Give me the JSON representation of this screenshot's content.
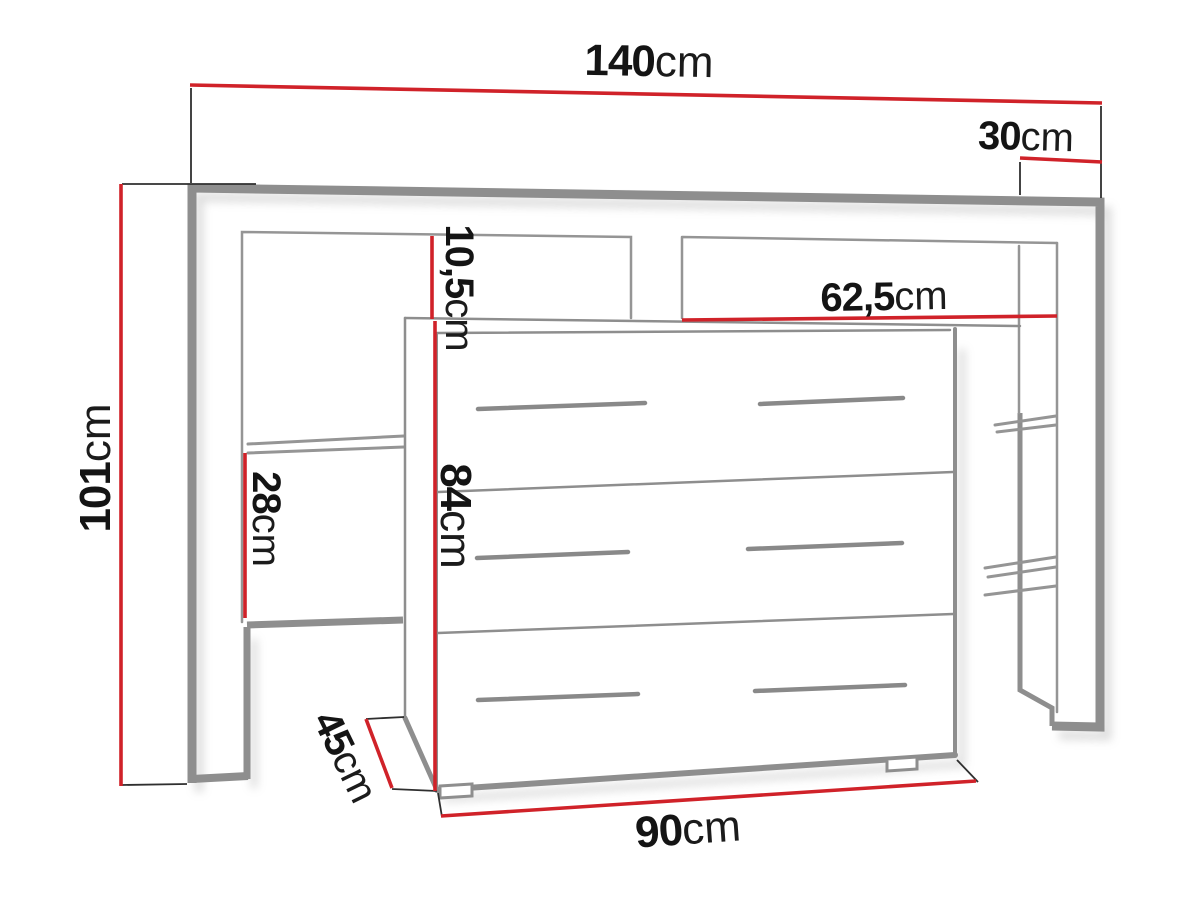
{
  "colors": {
    "dimension_line": "#d02229",
    "extension_line": "#2f2f2f",
    "furniture_outline": "#8e8e8e",
    "label_text": "#141414",
    "background": "#ffffff"
  },
  "dimensions": [
    {
      "id": "total_width",
      "value": "140",
      "unit": "cm"
    },
    {
      "id": "side_depth",
      "value": "30",
      "unit": "cm"
    },
    {
      "id": "total_height",
      "value": "101",
      "unit": "cm"
    },
    {
      "id": "niche_gap",
      "value": "10,5",
      "unit": "cm"
    },
    {
      "id": "niche_width",
      "value": "62,5",
      "unit": "cm"
    },
    {
      "id": "shelf_opening",
      "value": "28",
      "unit": "cm"
    },
    {
      "id": "dresser_height",
      "value": "84",
      "unit": "cm"
    },
    {
      "id": "dresser_depth",
      "value": "45",
      "unit": "cm"
    },
    {
      "id": "dresser_width",
      "value": "90",
      "unit": "cm"
    }
  ]
}
